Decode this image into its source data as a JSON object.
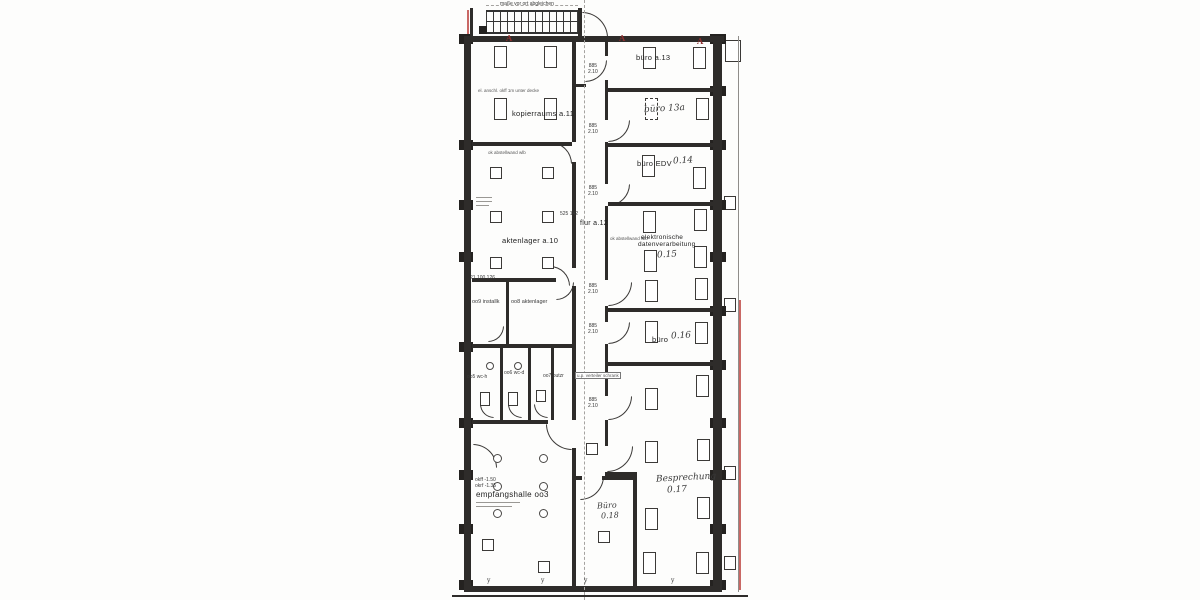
{
  "colors": {
    "ink": "#2e2c2a",
    "markup_red": "#ba3e3a",
    "paper": "#fdfdfc"
  },
  "rooms": {
    "kopierraum": "kopierraums a.11",
    "aktenlager_a10": "aktenlager a.10",
    "flur": "flur a.12",
    "install_009": "oo9 installk",
    "aktenlager_008": "oo8 aktenlager",
    "wc_005": "oo5 wc-h",
    "wc_006": "oo6 wc-d",
    "putzraum_007": "oo7 putzr",
    "empfangshalle": "empfangshalle oo3",
    "buero_013": "büro a.13",
    "buero_013a": "büro 13a",
    "buero_edv": "büro EDV",
    "buero_edv_nr": "0.14",
    "edv_line1": "elektronische",
    "edv_line2": "datenverarbeitung",
    "edv_nr": "0.15",
    "buero_016": "büro",
    "buero_016_nr": "0.16",
    "besprechung": "Besprechung",
    "besprechung_nr": "0.17",
    "buero_018": "Büro",
    "buero_018_nr": "0.18"
  },
  "annotations": {
    "stair_note": "maße vor ort abgleichen",
    "kopier_note": "el. anschl. okff 1m unter decke",
    "wall_note": "ok abstellwand wlb",
    "door_width": "885",
    "door_height": "2.10",
    "corridor_dims": "525   142",
    "left_dims": "21  100  126",
    "level_okff": "okff -1.50",
    "level_okrf": "okrf -1.35",
    "cabinet": "u.p. verteiler schrank",
    "mark_a": "A",
    "mark_y": "y"
  }
}
